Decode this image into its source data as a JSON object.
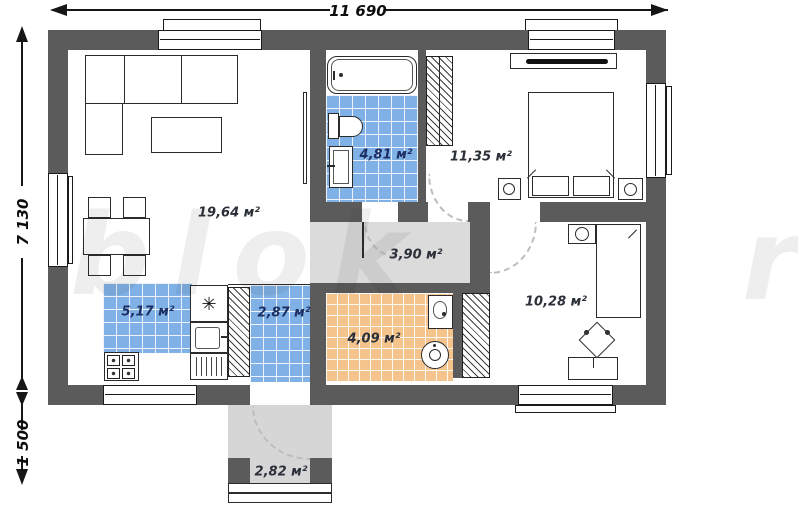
{
  "dimensions": {
    "total_width": "11 690",
    "total_height": "7 130",
    "porch_depth": "1 500"
  },
  "rooms": {
    "living_room": {
      "area_label": "19,64 м²"
    },
    "bathroom": {
      "area_label": "4,81 м²"
    },
    "bedroom": {
      "area_label": "11,35 м²"
    },
    "corridor": {
      "area_label": "3,90 м²"
    },
    "kitchen": {
      "area_label": "5,17 м²"
    },
    "hallway": {
      "area_label": "2,87 м²"
    },
    "utility_room": {
      "area_label": "4,09 м²"
    },
    "second_bedroom": {
      "area_label": "10,28 м²"
    },
    "porch": {
      "area_label": "2,82 м²"
    }
  },
  "symbols": {
    "refrigerator_star": "✳"
  },
  "watermark": {
    "main": "blok",
    "tail": "r"
  },
  "colors": {
    "wall": "#5b5b5b",
    "tile_blue": "#7fb1e6",
    "tile_orange": "#f5c38c",
    "corridor_floor": "#dbdbdb",
    "porch_floor": "#d6d6d6"
  }
}
